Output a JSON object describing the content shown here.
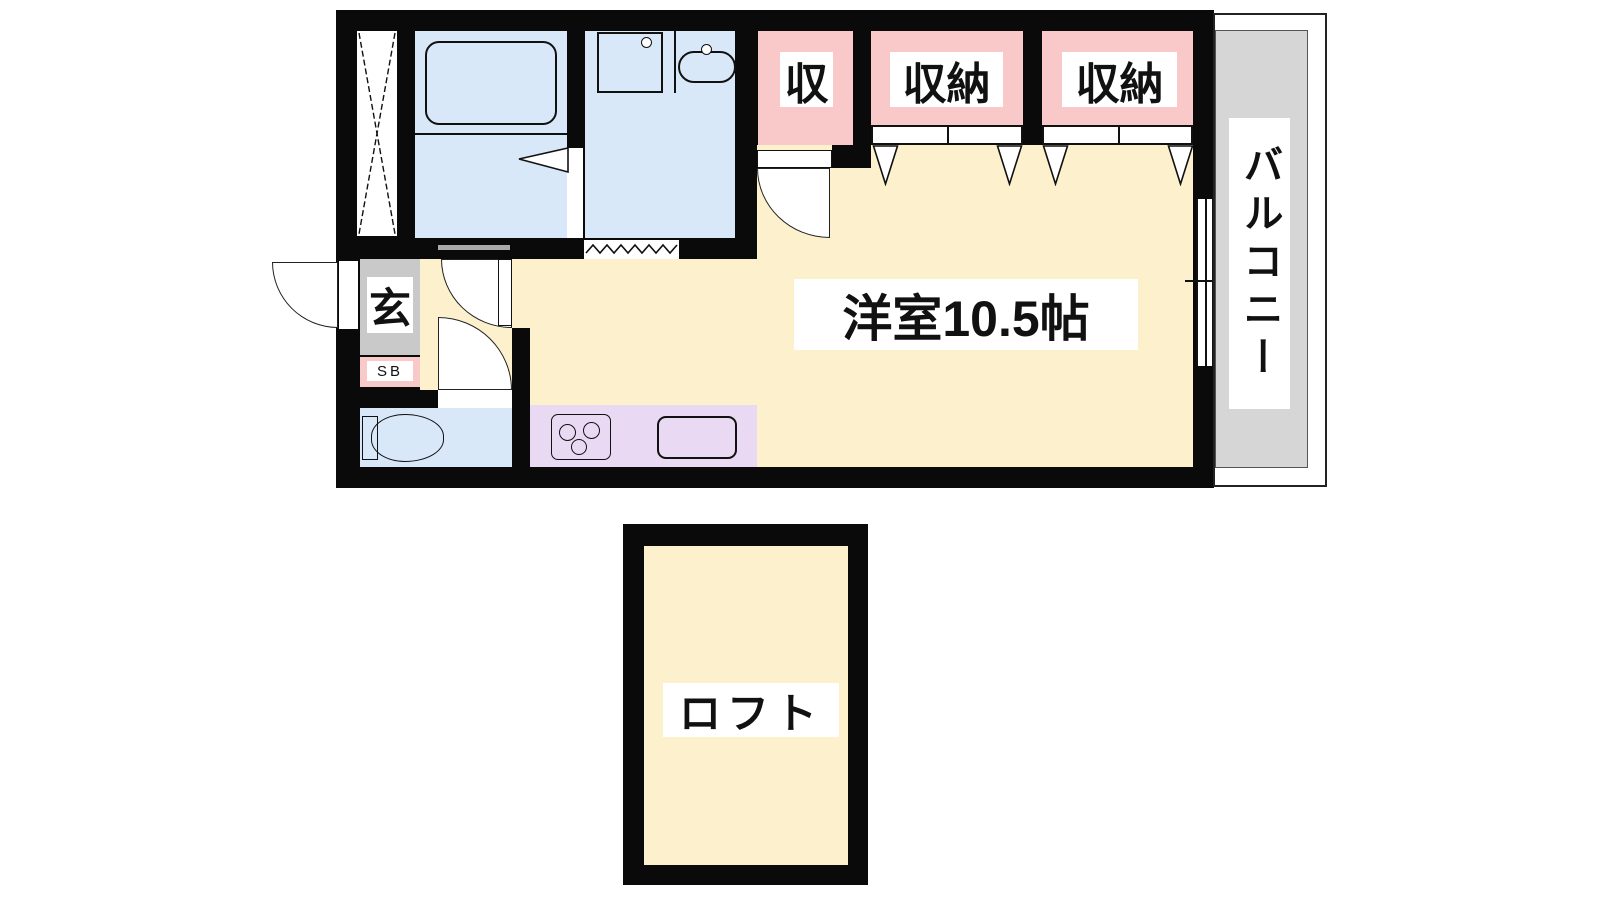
{
  "plan_title": "1R apartment floor plan with loft",
  "rooms": {
    "western_room": {
      "label": "洋室10.5帖"
    },
    "balcony": {
      "label": "バルコニー"
    },
    "loft": {
      "label": "ロフト"
    },
    "entrance": {
      "label": "玄"
    },
    "shoe_box": {
      "label": "SB"
    },
    "closet_1": {
      "label": "収"
    },
    "closet_2": {
      "label": "収納"
    },
    "closet_3": {
      "label": "収納"
    }
  },
  "colors": {
    "wall_black": "#0a0a0a",
    "room_cream": "#fcf0cd",
    "water_blue": "#d9e8f8",
    "closet_pink": "#f9c9c9",
    "kitchen_purple": "#ead9f2",
    "entrance_gray": "#c9c9c9",
    "balcony_gray": "#d6d6d6",
    "label_bg": "#ffffff"
  }
}
